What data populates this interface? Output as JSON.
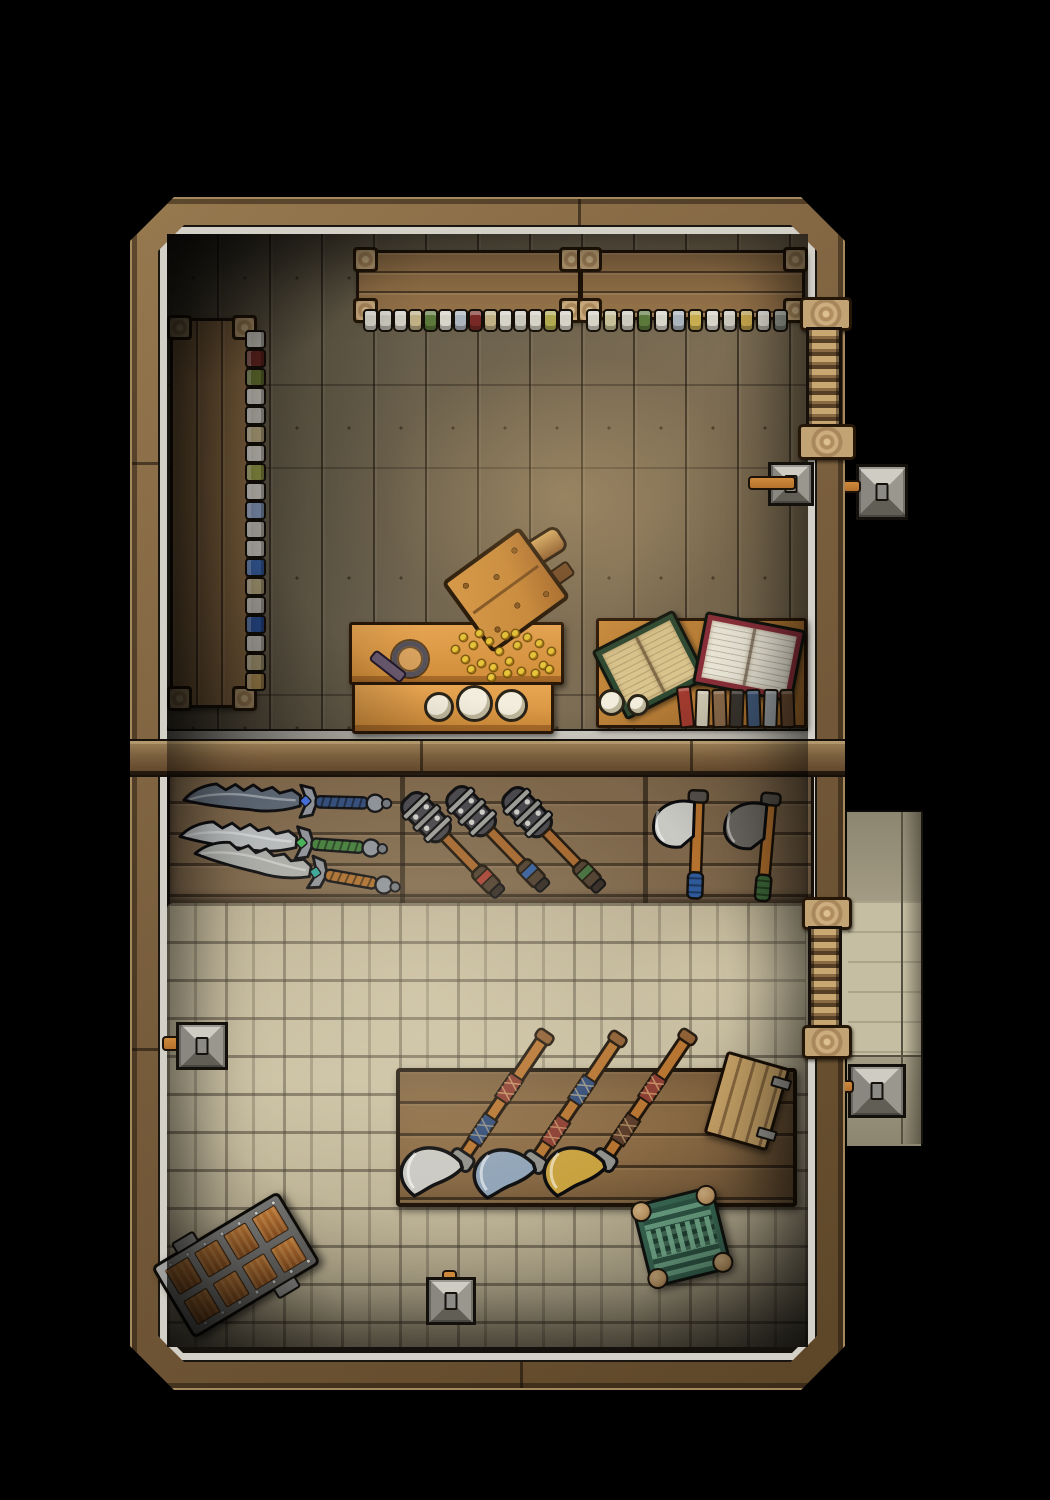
{
  "map": {
    "description": "Top-down fantasy battle map of a two-room weapon shop",
    "rooms": [
      {
        "name": "workshop-storeroom",
        "floor": "wooden planks"
      },
      {
        "name": "shop-floor",
        "floor": "stone bricks"
      }
    ]
  },
  "palette": {
    "bg": "#000000",
    "wall-wood": "#7a5f3e",
    "trim": "#d3d0c7",
    "rack": "#7d664a",
    "shelf-wood": "#97744a",
    "table-orange-1": "#d08c38",
    "table-orange-2": "#e8a653",
    "desk-wood-1": "#a06a2c",
    "desk-wood-2": "#c98c3e",
    "crate-1": "#c98a3a",
    "door-rung": "#c9a771",
    "torch-wood": "#b5712c",
    "coin": "#e8c53a",
    "candle": "#f2eddc",
    "chest-metal-1": "#858583",
    "chest-wood-1": "#b06a2e",
    "stool-base": "#3a6b57",
    "stool-stripe": "#7ab695",
    "stool-knob": "#c9a06a",
    "lantern-1": "#cfccc3",
    "lantern-2": "#9a978e",
    "lantern-3": "#615e56",
    "lantern-4": "#8a8780",
    "porch-1": "#9a937c",
    "porch-2": "#8c8570",
    "porch-3": "#c6bea2"
  },
  "shelves": {
    "front_left_bottles": [
      "#d9d6cb",
      "#cfccc1",
      "#d9d6cb",
      "#c4b488",
      "#5d7a3c",
      "#d9d6cb",
      "#aeb6bf",
      "#7a2a26",
      "#c4b488",
      "#d9d6cb",
      "#cfccc1",
      "#d9d6cb",
      "#b3ad52",
      "#d9d6cb"
    ],
    "front_right_bottles": [
      "#d9d6cb",
      "#c9c29a",
      "#cfccc1",
      "#5d7a3c",
      "#d9d6cb",
      "#aeb6bf",
      "#c9b052",
      "#d9d6cb",
      "#cfccc1",
      "#c9a94e",
      "#d9d6cb",
      "#8f948a"
    ],
    "side_bench_bottles": [
      "#d9d6cb",
      "#6e2a24",
      "#6b7a34",
      "#d9d6cb",
      "#cfccc1",
      "#c4b488",
      "#d9d6cb",
      "#9aa04a",
      "#d9d6cb",
      "#8fa3c9",
      "#cfccc1",
      "#d9d6cb",
      "#3f6bb5",
      "#c4b488",
      "#cfccc1",
      "#2f59a8",
      "#d9d6cb",
      "#c4b488",
      "#c9a35f"
    ]
  },
  "sales_counter": {
    "coin_offsets": [
      [
        0,
        16
      ],
      [
        8,
        4
      ],
      [
        10,
        26
      ],
      [
        18,
        12
      ],
      [
        24,
        0
      ],
      [
        26,
        30
      ],
      [
        34,
        8
      ],
      [
        38,
        34
      ],
      [
        44,
        18
      ],
      [
        50,
        2
      ],
      [
        54,
        28
      ],
      [
        62,
        12
      ],
      [
        66,
        38
      ],
      [
        72,
        4
      ],
      [
        78,
        22
      ],
      [
        84,
        10
      ],
      [
        88,
        32
      ],
      [
        52,
        40
      ],
      [
        16,
        36
      ],
      [
        36,
        44
      ],
      [
        80,
        40
      ],
      [
        96,
        18
      ],
      [
        94,
        36
      ],
      [
        60,
        0
      ]
    ],
    "bench_candles": [
      "#f2eddc",
      "#f2eddc",
      "#f2eddc"
    ]
  },
  "book_desk": {
    "open_books": [
      {
        "cover": "#2f4a33",
        "pages": "#d9c48e"
      },
      {
        "cover": "#8a2f3a",
        "pages": "#e8e4d6"
      }
    ],
    "book_spines": [
      "#a33b2f",
      "#cfc8b2",
      "#8a6a4a",
      "#3a352f",
      "#41597a",
      "#9aa0a3",
      "#6b4a2f"
    ],
    "candles": [
      "#f2eddc",
      "#f2eddc"
    ]
  },
  "weapon_racks": {
    "daggers": [
      {
        "blade": "#5a6470",
        "grip": "#2f4a78",
        "gem": "#3f6bd6"
      },
      {
        "blade": "#b5b8ba",
        "grip": "#3f7a38",
        "gem": "#3fae52"
      },
      {
        "blade": "#a8aaa6",
        "grip": "#a86a28",
        "gem": "#2fa392"
      }
    ],
    "clubs": [
      {
        "accent": "#a23b2f"
      },
      {
        "accent": "#2f5a9a"
      },
      {
        "accent": "#3f6b3a"
      }
    ],
    "hand_axes": [
      {
        "head": "#c9c9c4",
        "wrap": "#2f5a9a"
      },
      {
        "head": "#6e6a64",
        "wrap": "#3f6b3a"
      }
    ]
  },
  "display_counter": {
    "axes": [
      {
        "head": "#c9c9c4",
        "wrapA": "#8a3b2f",
        "wrapB": "#2f4a78"
      },
      {
        "head": "#8fa3b8",
        "wrapA": "#2f4a78",
        "wrapB": "#8a3b2f"
      },
      {
        "head": "#c8a13e",
        "wrapA": "#8a3b2f",
        "wrapB": "#5a3a28"
      }
    ]
  }
}
